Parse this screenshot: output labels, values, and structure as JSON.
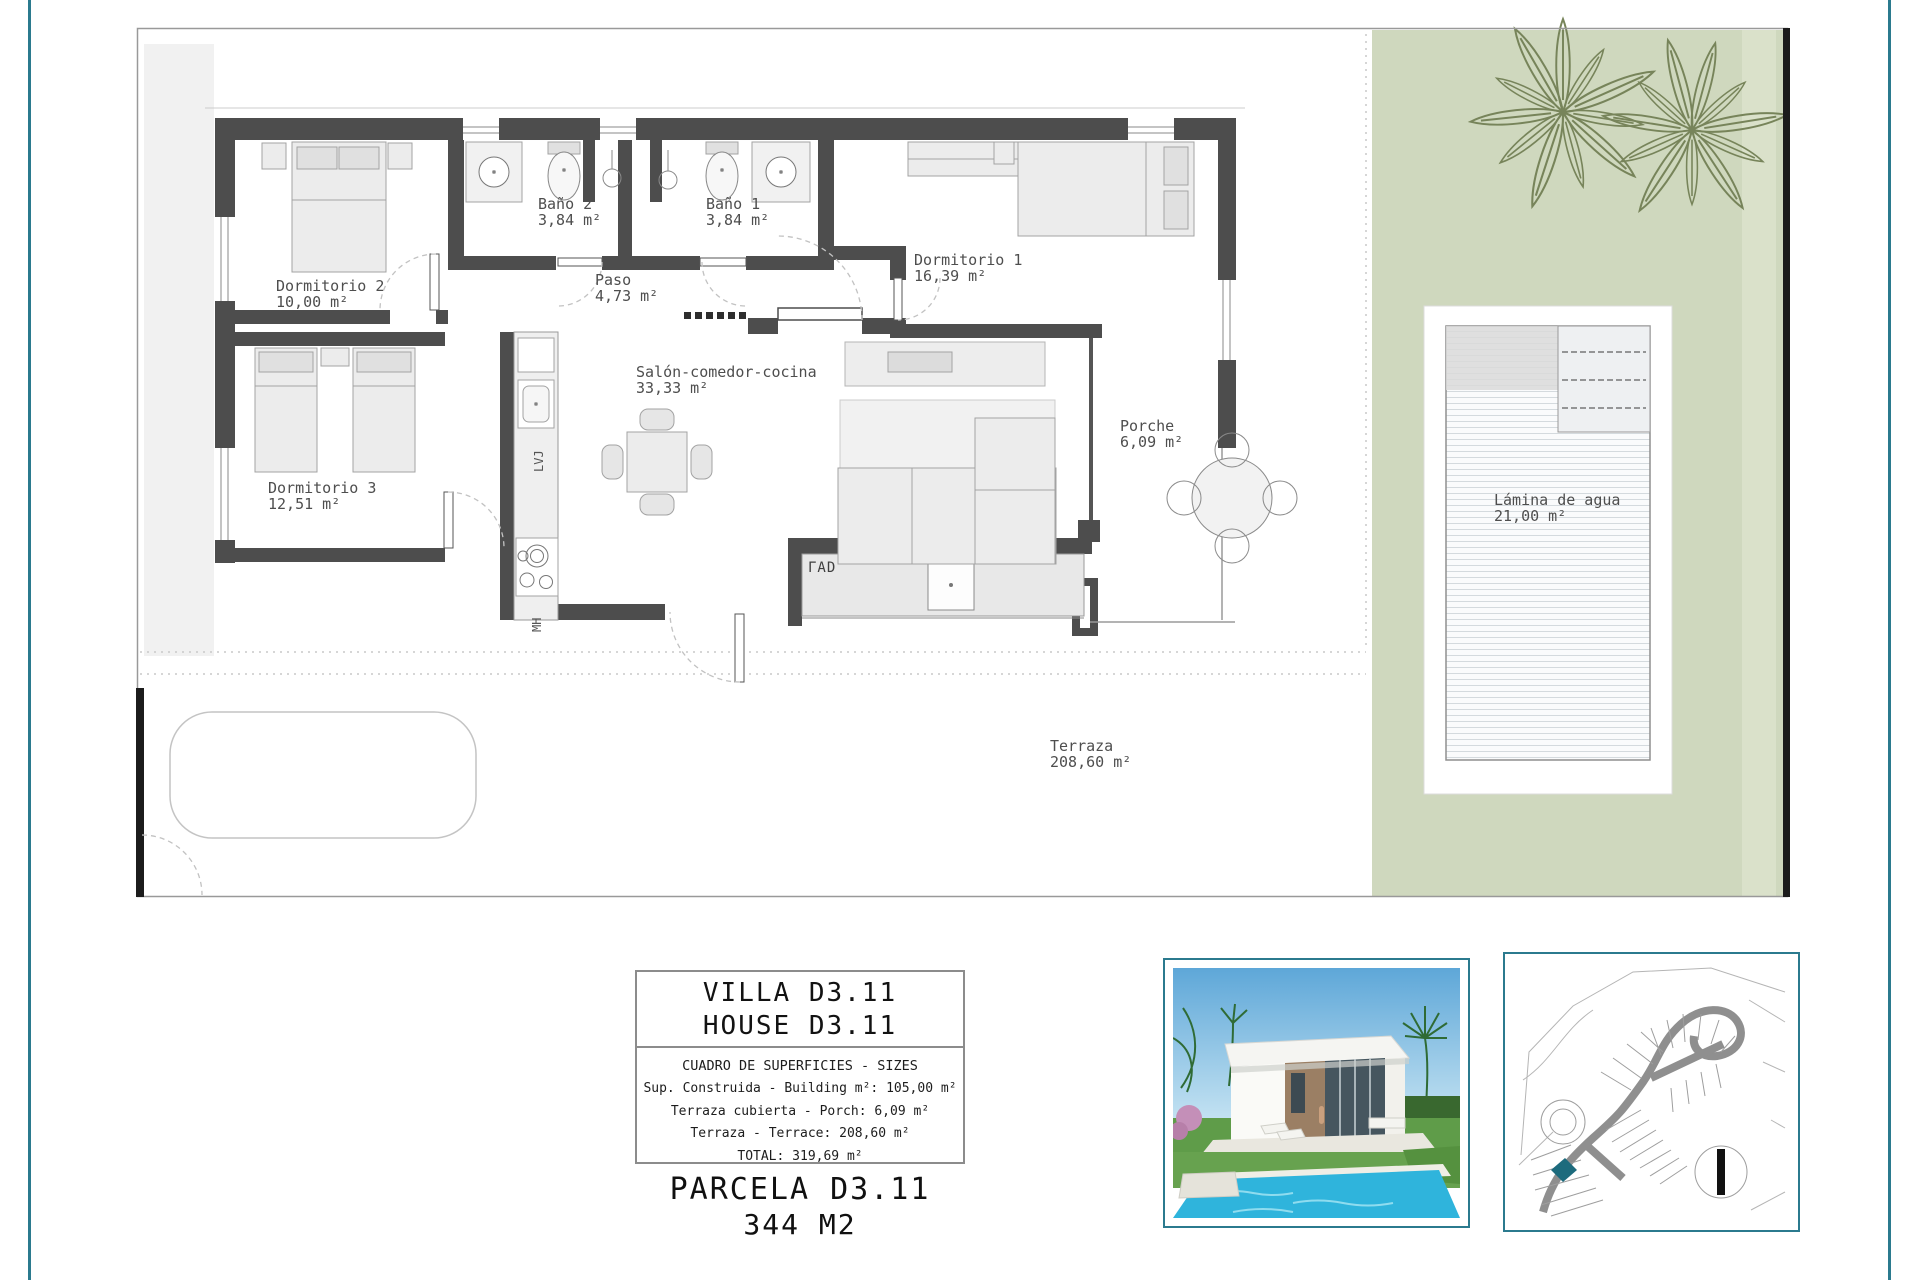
{
  "plan": {
    "rooms": [
      {
        "name": "Dormitorio 2",
        "area": "10,00 m²"
      },
      {
        "name": "Baño 2",
        "area": "3,84 m²"
      },
      {
        "name": "Baño 1",
        "area": "3,84 m²"
      },
      {
        "name": "Paso",
        "area": "4,73 m²"
      },
      {
        "name": "Dormitorio 1",
        "area": "16,39 m²"
      },
      {
        "name": "Dormitorio 3",
        "area": "12,51 m²"
      },
      {
        "name": "Salón-comedor-cocina",
        "area": "33,33 m²"
      },
      {
        "name": "Porche",
        "area": "6,09 m²"
      },
      {
        "name": "Terraza",
        "area": "208,60 m²"
      },
      {
        "name": "Lámina de agua",
        "area": "21,00 m²"
      }
    ],
    "appliance_labels": {
      "dishwasher": "LVJ",
      "microwave": "MH",
      "tv_unit": "ΓAD"
    }
  },
  "info_box": {
    "title_line1": "VILLA D3.11",
    "title_line2": "HOUSE D3.11",
    "table_header": "CUADRO DE SUPERFICIES  -  SIZES",
    "rows": [
      "Sup. Construida  -  Building m²: 105,00 m²",
      "Terraza cubierta  -  Porch: 6,09 m²",
      "Terraza  -  Terrace: 208,60 m²",
      "TOTAL:  319,69 m²"
    ]
  },
  "parcel": {
    "name": "PARCELA D3.11",
    "area": "344 M2"
  },
  "colors": {
    "frame": "#2b7a8e",
    "garden": "#cfd8be",
    "wall": "#4d4d4d",
    "plot_highlight": "#1d6b7d"
  }
}
